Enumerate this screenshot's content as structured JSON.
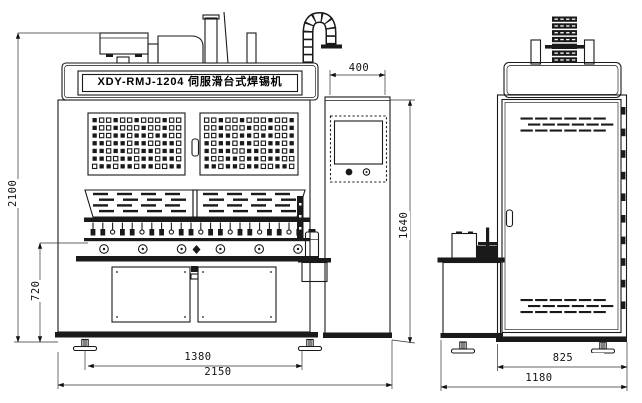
{
  "drawing": {
    "title_label": "XDY-RMJ-1204 伺服滑台式焊锡机",
    "dims": {
      "overall_height": "2100",
      "work_height": "720",
      "panel_width": "400",
      "panel_top_height": "1640",
      "feet_span": "1380",
      "overall_width": "2150",
      "cabinet_depth": "825",
      "overall_depth": "1180"
    },
    "colors": {
      "line": "#1a1a1a",
      "background": "#ffffff"
    }
  }
}
